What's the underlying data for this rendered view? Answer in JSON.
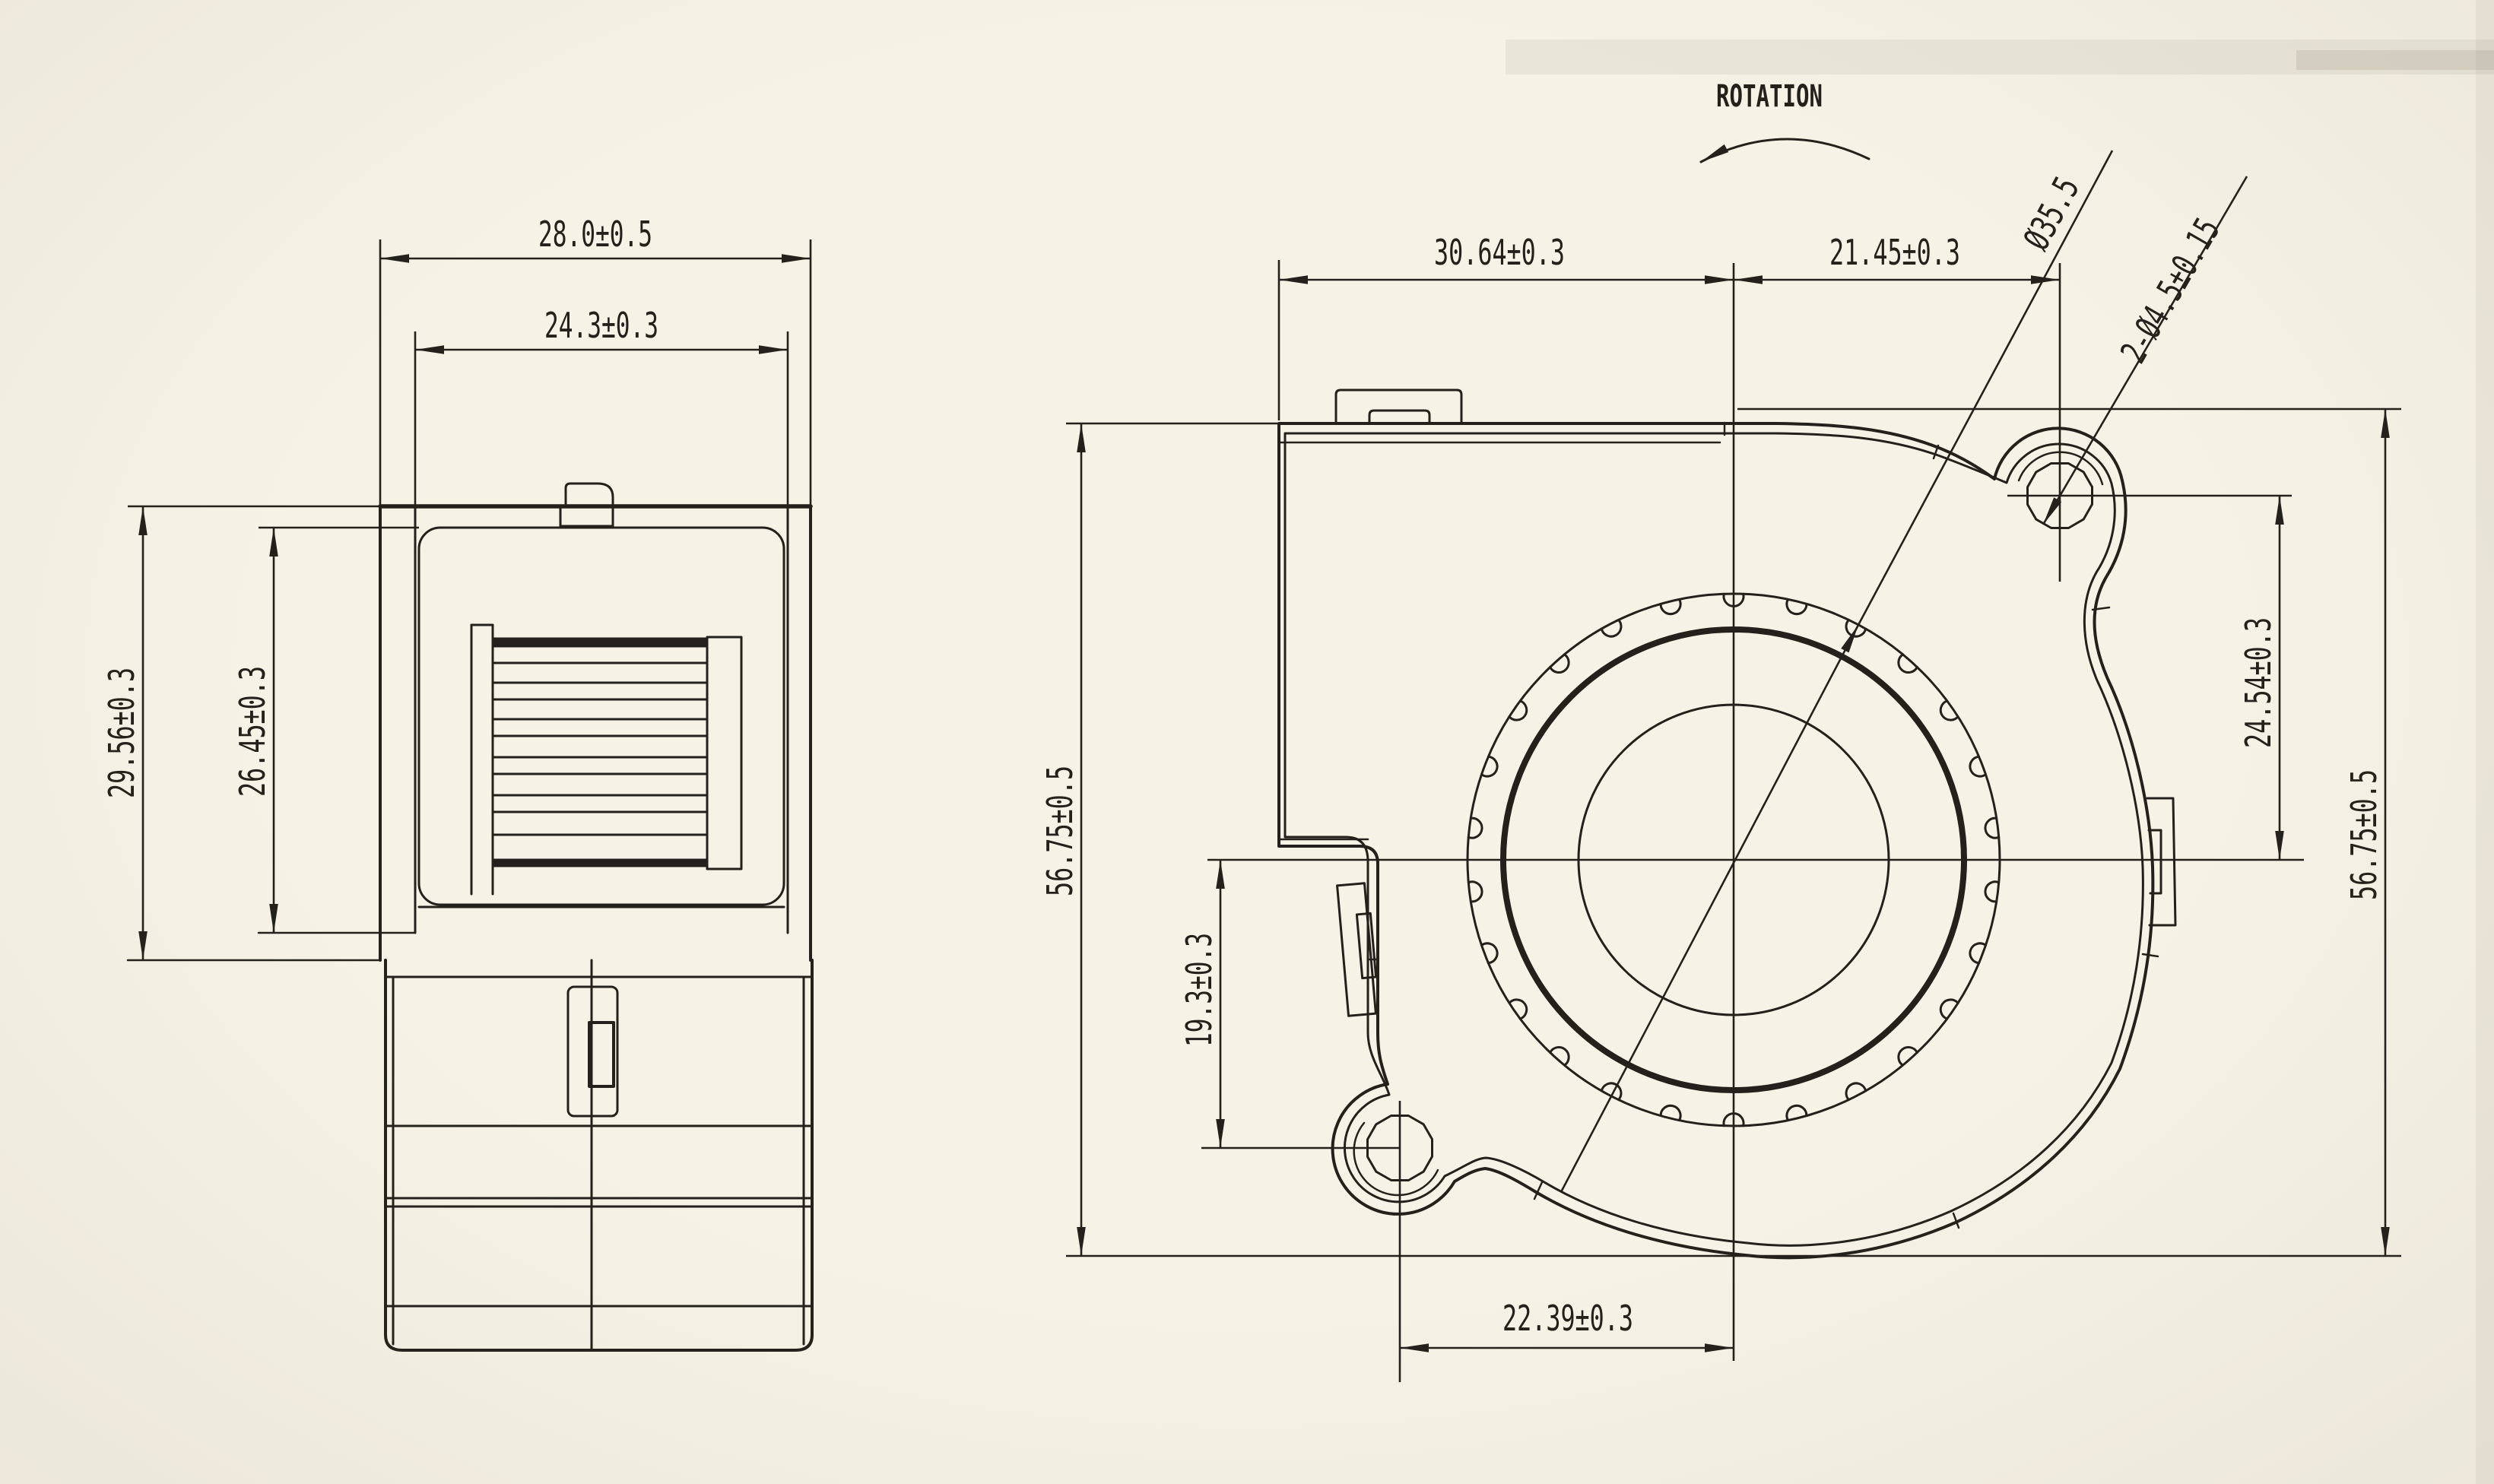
{
  "colors": {
    "paper": "#f6f2e6",
    "ink": "#24211c"
  },
  "side_view": {
    "dim_outer_width": "28.0±0.5",
    "dim_inner_width": "24.3±0.3",
    "dim_outer_height": "29.56±0.3",
    "dim_inner_height": "26.45±0.3"
  },
  "front_view": {
    "rotation_label": "ROTATION",
    "dim_left_to_center": "30.64±0.3",
    "dim_center_to_hole": "21.45±0.3",
    "dim_height_left": "56.75±0.5",
    "dim_height_right": "56.75±0.5",
    "dim_hole_to_center_vertical": "24.54±0.3",
    "dim_center_to_lower_hole": "19.3±0.3",
    "dim_lower_hole_to_center": "22.39±0.3",
    "label_impeller_diameter": "Ø35.5",
    "label_mounting_holes": "2-Ø4.5±0.15"
  }
}
